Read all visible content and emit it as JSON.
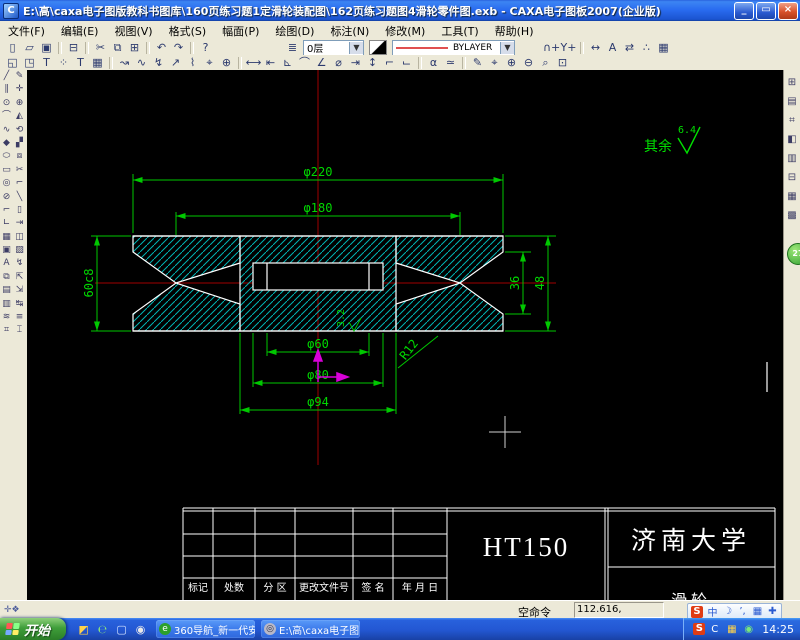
{
  "window": {
    "title": "E:\\高\\caxa电子图版教科书图库\\160页练习题1定滑轮装配图\\162页练习题图4滑轮零件图.exb - CAXA电子图板2007(企业版)",
    "app_initial": "C",
    "minimize": "_",
    "restore": "▭",
    "close": "×"
  },
  "menu": {
    "items_text": "",
    "items": [
      {
        "n": "menu-file",
        "g": "文件(F)"
      },
      {
        "n": "menu-edit",
        "g": "编辑(E)"
      },
      {
        "n": "menu-view",
        "g": "视图(V)"
      },
      {
        "n": "menu-format",
        "g": "格式(S)"
      },
      {
        "n": "menu-sheet",
        "g": "幅面(P)"
      },
      {
        "n": "menu-draw",
        "g": "绘图(D)"
      },
      {
        "n": "menu-dimension",
        "g": "标注(N)"
      },
      {
        "n": "menu-modify",
        "g": "修改(M)"
      },
      {
        "n": "menu-tools",
        "g": "工具(T)"
      },
      {
        "n": "menu-help",
        "g": "帮助(H)"
      }
    ]
  },
  "toolbar1": {
    "left_icons": [
      {
        "n": "new-button",
        "g": "▯"
      },
      {
        "n": "open-button",
        "g": "▱"
      },
      {
        "n": "save-button",
        "g": "▣"
      },
      {
        "n": "separator",
        "g": ""
      },
      {
        "n": "print-button",
        "g": "⊟"
      },
      {
        "n": "separator",
        "g": ""
      },
      {
        "n": "cut-button",
        "g": "✂"
      },
      {
        "n": "copy-button",
        "g": "⧉"
      },
      {
        "n": "paste-button",
        "g": "⊞"
      },
      {
        "n": "separator",
        "g": ""
      },
      {
        "n": "undo-button",
        "g": "↶"
      },
      {
        "n": "redo-button",
        "g": "↷"
      },
      {
        "n": "separator",
        "g": ""
      },
      {
        "n": "help-button",
        "g": "?"
      }
    ],
    "layer_icon": "≣",
    "layer_value": "0层",
    "linetype_value": "BYLAYER",
    "right_icons": [
      {
        "n": "node-pick-button",
        "g": "∩+"
      },
      {
        "n": "point-pick-button",
        "g": "Y+"
      },
      {
        "n": "separator",
        "g": ""
      },
      {
        "n": "transform-move-button",
        "g": "↔"
      },
      {
        "n": "transform-mirror-button",
        "g": "A"
      },
      {
        "n": "transform-rotate-button",
        "g": "⇄"
      },
      {
        "n": "transform-array-button",
        "g": "∴"
      },
      {
        "n": "block-button",
        "g": "▦"
      }
    ]
  },
  "toolbar2": {
    "icons": [
      {
        "n": "frame-zoom-button",
        "g": "◱"
      },
      {
        "n": "frame-settings-button",
        "g": "◳"
      },
      {
        "n": "text-style-button",
        "g": "T"
      },
      {
        "n": "point-style-button",
        "g": "⁘"
      },
      {
        "n": "text-button",
        "g": "T"
      },
      {
        "n": "table-button",
        "g": "▦"
      },
      {
        "n": "separator",
        "g": ""
      },
      {
        "n": "leader-button",
        "g": "↝"
      },
      {
        "n": "curve-button",
        "g": "∿"
      },
      {
        "n": "break-line-button",
        "g": "↯"
      },
      {
        "n": "arrow-button",
        "g": "↗"
      },
      {
        "n": "profile-button",
        "g": "⌇"
      },
      {
        "n": "inspect-button",
        "g": "⌖"
      },
      {
        "n": "center-button",
        "g": "⊕"
      },
      {
        "n": "separator",
        "g": ""
      },
      {
        "n": "dim-linear-button",
        "g": "⟷"
      },
      {
        "n": "dim-baseline-button",
        "g": "⇤"
      },
      {
        "n": "dim-angle-button",
        "g": "⊾"
      },
      {
        "n": "dim-arc-button",
        "g": "⌒"
      },
      {
        "n": "dim-angle2-button",
        "g": "∠"
      },
      {
        "n": "dim-diameter-button",
        "g": "⌀"
      },
      {
        "n": "dim-offset-button",
        "g": "⇥"
      },
      {
        "n": "dim-vertical-button",
        "g": "↕"
      },
      {
        "n": "dim-leader-button",
        "g": "⌐"
      },
      {
        "n": "dim-chain-button",
        "g": "⌙"
      },
      {
        "n": "separator",
        "g": ""
      },
      {
        "n": "symbol-alpha-button",
        "g": "α"
      },
      {
        "n": "tolerance-button",
        "g": "≃"
      },
      {
        "n": "separator",
        "g": ""
      },
      {
        "n": "redraw-button",
        "g": "✎"
      },
      {
        "n": "pan-button",
        "g": "⌖"
      },
      {
        "n": "zoom-in-button",
        "g": "⊕"
      },
      {
        "n": "zoom-out-button",
        "g": "⊖"
      },
      {
        "n": "zoom-window-button",
        "g": "⌕"
      },
      {
        "n": "zoom-all-button",
        "g": "⊡"
      }
    ]
  },
  "palette": {
    "col1": [
      {
        "n": "tool-line",
        "g": "╱"
      },
      {
        "n": "tool-parallel",
        "g": "∥"
      },
      {
        "n": "tool-circle",
        "g": "⊙"
      },
      {
        "n": "tool-arc",
        "g": "⌒"
      },
      {
        "n": "tool-spline",
        "g": "∿"
      },
      {
        "n": "tool-fill",
        "g": "◆"
      },
      {
        "n": "tool-ellipse",
        "g": "⬭"
      },
      {
        "n": "tool-rect",
        "g": "▭"
      },
      {
        "n": "tool-point",
        "g": "◎"
      },
      {
        "n": "tool-eraser",
        "g": "⊘"
      },
      {
        "n": "tool-polyline",
        "g": "⌐"
      },
      {
        "n": "tool-chamfer",
        "g": "∟"
      },
      {
        "n": "tool-hatch",
        "g": "▦"
      },
      {
        "n": "tool-image",
        "g": "▣"
      },
      {
        "n": "tool-text",
        "g": "A"
      },
      {
        "n": "tool-block",
        "g": "⧉"
      },
      {
        "n": "tool-table",
        "g": "▤"
      },
      {
        "n": "tool-detail",
        "g": "▥"
      },
      {
        "n": "tool-wave",
        "g": "≋"
      },
      {
        "n": "tool-grid",
        "g": "⌗"
      }
    ],
    "col2": [
      {
        "n": "tool-sketch",
        "g": "✎"
      },
      {
        "n": "tool-move",
        "g": "✛"
      },
      {
        "n": "tool-rotate",
        "g": "⊕"
      },
      {
        "n": "tool-mirror",
        "g": "◭"
      },
      {
        "n": "tool-scale",
        "g": "⟲"
      },
      {
        "n": "tool-array",
        "g": "▞"
      },
      {
        "n": "tool-block2",
        "g": "⧈"
      },
      {
        "n": "tool-break",
        "g": "✂"
      },
      {
        "n": "tool-fillet",
        "g": "⌐"
      },
      {
        "n": "tool-line2",
        "g": "╲"
      },
      {
        "n": "tool-rect2",
        "g": "▯"
      },
      {
        "n": "tool-extend",
        "g": "⇥"
      },
      {
        "n": "tool-stretch",
        "g": "◫"
      },
      {
        "n": "tool-hatch2",
        "g": "▨"
      },
      {
        "n": "tool-explode",
        "g": "↯"
      },
      {
        "n": "tool-corner",
        "g": "⇱"
      },
      {
        "n": "tool-trim",
        "g": "⇲"
      },
      {
        "n": "tool-offset",
        "g": "↹"
      },
      {
        "n": "tool-layers",
        "g": "≡"
      },
      {
        "n": "tool-beam",
        "g": "⌶"
      }
    ]
  },
  "rightstrip": {
    "icons": [
      {
        "n": "library-button",
        "g": "⊞"
      },
      {
        "n": "browser-button",
        "g": "▤"
      },
      {
        "n": "symbol-lib-button",
        "g": "⌗"
      },
      {
        "n": "image-lib-button",
        "g": "◧"
      },
      {
        "n": "title-lib-button",
        "g": "▥"
      },
      {
        "n": "frame-lib-button",
        "g": "⊟"
      },
      {
        "n": "hatch-lib-button",
        "g": "▦"
      },
      {
        "n": "part-lib-button",
        "g": "▩"
      }
    ]
  },
  "drawing": {
    "dims": {
      "phi220": "φ220",
      "phi180": "φ180",
      "phi60": "φ60",
      "phi80": "φ80",
      "phi94": "φ94",
      "height_left": "60c8",
      "w36": "36",
      "w48": "48",
      "r12": "R12",
      "bore_roughness": "3.2",
      "other_label": "其余",
      "other_roughness": "6.4"
    },
    "title_block": {
      "material": "HT150",
      "organization": "济南大学",
      "part_name": "滑轮",
      "labels": [
        "标记",
        "处数",
        "分 区",
        "更改文件号",
        "签 名",
        "年 月 日"
      ]
    },
    "colors": {
      "dimension": "#00c800",
      "outline": "#ffffff",
      "hatch": "#00b4b4",
      "centerline": "#a00000",
      "marker": "#d800d8"
    }
  },
  "status": {
    "left_icons": [
      {
        "n": "ortho-toggle-icon",
        "g": "✛"
      },
      {
        "n": "snap-toggle-icon",
        "g": "❖"
      }
    ],
    "command": "空命令",
    "coordinates": "112.616, -32.151",
    "sogou_items": [
      {
        "n": "sogou-logo-icon",
        "g": "S"
      },
      {
        "n": "ime-chinese-icon",
        "g": "中"
      },
      {
        "n": "ime-moon-icon",
        "g": "☽"
      },
      {
        "n": "ime-punct-icon",
        "g": "’,"
      },
      {
        "n": "ime-keyboard-icon",
        "g": "▦"
      },
      {
        "n": "ime-tools-icon",
        "g": "✚"
      }
    ]
  },
  "taskbar": {
    "start": "开始",
    "quicklaunch": [
      {
        "n": "sogou-input-icon",
        "g": "◩"
      },
      {
        "n": "ie-icon",
        "g": "℮"
      },
      {
        "n": "folder-icon",
        "g": "▢"
      },
      {
        "n": "media-player-icon",
        "g": "◉"
      }
    ],
    "task1": "360导航_新一代安...",
    "task2": "E:\\高\\caxa电子图...",
    "tray_icons": [
      {
        "n": "sogou-tray-icon",
        "g": "S"
      },
      {
        "n": "ime-tray-icon",
        "g": "C"
      },
      {
        "n": "network-tray-icon",
        "g": "▦"
      },
      {
        "n": "security-tray-icon",
        "g": "◉"
      }
    ],
    "time": "14:25",
    "ball_count": "27"
  }
}
